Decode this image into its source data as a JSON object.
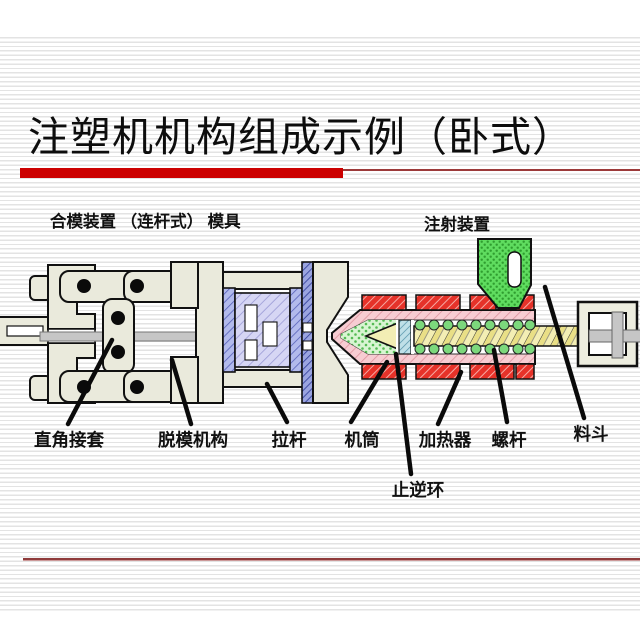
{
  "slide": {
    "title": "注塑机机构组成示例（卧式）"
  },
  "diagram": {
    "clamping_section_label": "合模装置 （连杆式） 模具",
    "injection_section_label": "注射装置",
    "part_labels": [
      "直角接套",
      "脱模机构",
      "拉杆",
      "机筒",
      "加热器",
      "螺杆",
      "料斗",
      "止逆环"
    ]
  },
  "colors": {
    "accent_bar": "#CC0000",
    "thin_rule": "#9C3A3A",
    "machine_body": "#EAEADC",
    "heater": "#E63229",
    "barrel": "#F7C9CF",
    "melt": "#CDEFC8",
    "screw": "#F3EEB4",
    "mold_block": "#D6D6F4",
    "mold_plate": "#AEB6EA",
    "check_ring": "#BFE0E8",
    "hopper": "#5FDC5F",
    "piston_rod": "#C6C6C6",
    "outline": "#111111"
  }
}
